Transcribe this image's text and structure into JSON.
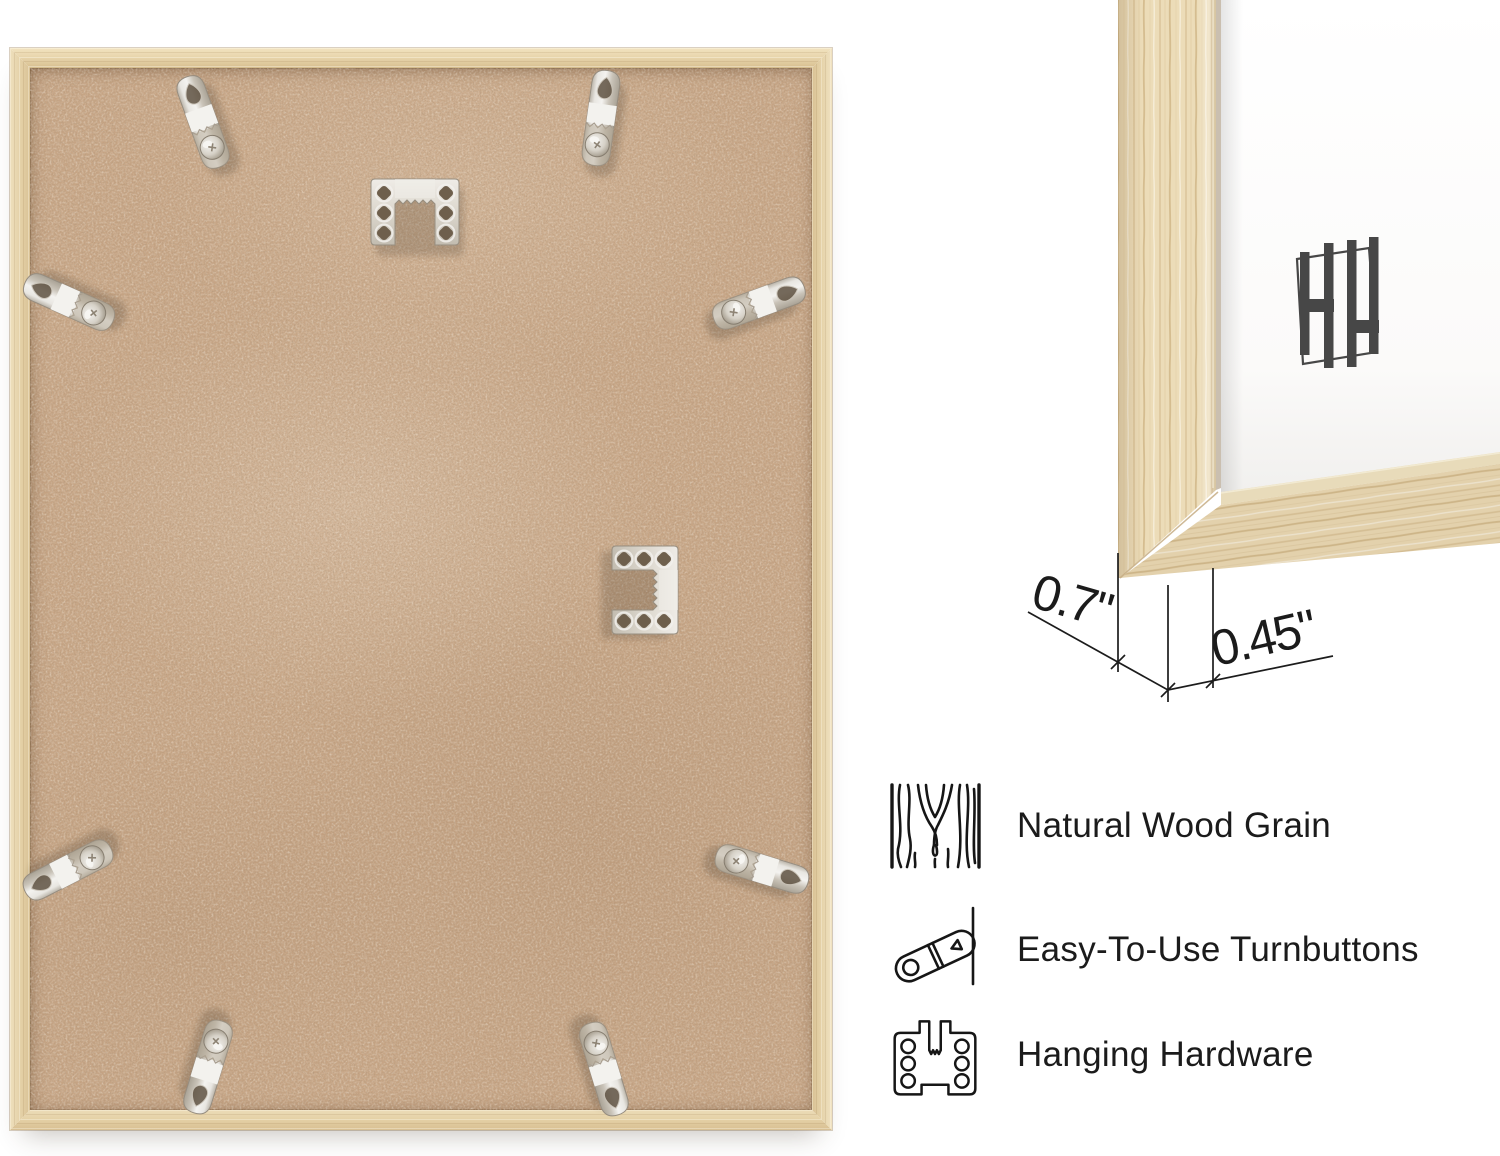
{
  "background": "#ffffff",
  "back_view": {
    "hardware": {
      "turnbuttons": 8,
      "sawtooth_hangers": 2
    }
  },
  "corner_view": {
    "logo_monogram": "HH",
    "dimensions": {
      "depth": "0.7\"",
      "face": "0.45\""
    }
  },
  "features": [
    {
      "icon": "wood-grain-icon",
      "label": "Natural Wood Grain"
    },
    {
      "icon": "turnbutton-icon",
      "label": "Easy-To-Use Turnbuttons"
    },
    {
      "icon": "hanging-hardware-icon",
      "label": "Hanging Hardware"
    }
  ],
  "colors": {
    "frame_wood": "#e7d3ab",
    "wood_grain": "#d8c196",
    "mdf_back": "#c7a585",
    "metal_hardware": "#d8d4cc",
    "logo": "#474747",
    "text": "#1b1b1b"
  }
}
